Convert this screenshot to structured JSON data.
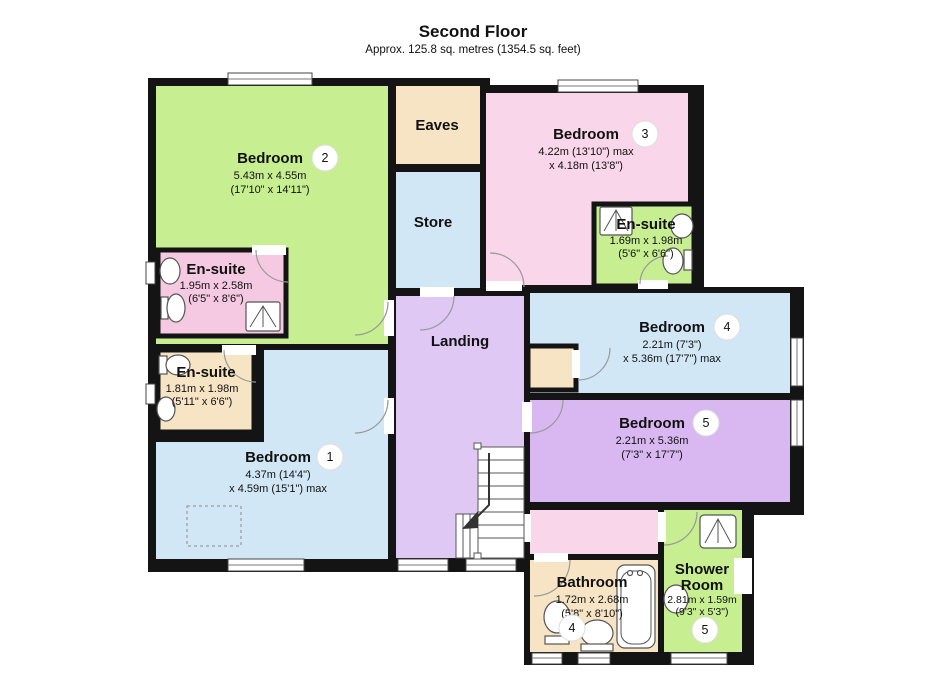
{
  "title": {
    "heading": "Second Floor",
    "subtitle": "Approx. 125.8 sq. metres (1354.5 sq. feet)"
  },
  "palette": {
    "wall": "#141414",
    "green": "#c7ee90",
    "pink": "#f9d6e9",
    "pink_deep": "#f5c9e1",
    "blue": "#d2e7f6",
    "tan": "#f7e4c4",
    "lavender": "#dfc9f4",
    "lilac": "#d9b8f1",
    "window_white": "#ffffff"
  },
  "rooms": {
    "bedroom1": {
      "label": "Bedroom",
      "badge": "1",
      "dim1": "4.37m (14'4\")",
      "dim2": "x 4.59m (15'1\") max"
    },
    "bedroom2": {
      "label": "Bedroom",
      "badge": "2",
      "dim1": "5.43m x 4.55m",
      "dim2": "(17'10\" x 14'11\")"
    },
    "bedroom3": {
      "label": "Bedroom",
      "badge": "3",
      "dim1": "4.22m (13'10\") max",
      "dim2": "x 4.18m (13'8\")"
    },
    "bedroom4": {
      "label": "Bedroom",
      "badge": "4",
      "dim1": "2.21m (7'3\")",
      "dim2": "x 5.36m (17'7\") max"
    },
    "bedroom5": {
      "label": "Bedroom",
      "badge": "5",
      "dim1": "2.21m x 5.36m",
      "dim2": "(7'3\" x 17'7\")"
    },
    "ensuite1": {
      "label": "En-suite",
      "dim1": "1.81m x 1.98m",
      "dim2": "(5'11\" x 6'6\")"
    },
    "ensuite2": {
      "label": "En-suite",
      "dim1": "1.95m x 2.58m",
      "dim2": "(6'5\" x 8'6\")"
    },
    "ensuite3": {
      "label": "En-suite",
      "dim1": "1.69m x 1.98m",
      "dim2": "(5'6\" x 6'6\")"
    },
    "eaves": {
      "label": "Eaves"
    },
    "store": {
      "label": "Store"
    },
    "landing": {
      "label": "Landing"
    },
    "bathroom": {
      "label": "Bathroom",
      "badge": "4",
      "dim1": "1.72m x 2.68m",
      "dim2": "(5'8\" x 8'10\")"
    },
    "shower_room": {
      "label1": "Shower",
      "label2": "Room",
      "badge": "5",
      "dim1": "2.81m x 1.59m",
      "dim2": "(9'3\" x 5'3\")"
    }
  }
}
